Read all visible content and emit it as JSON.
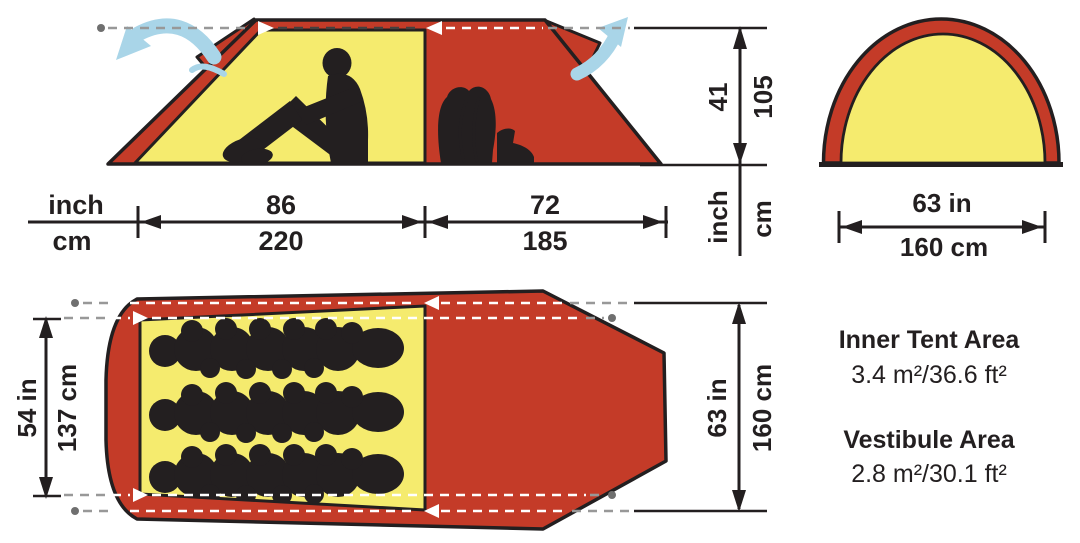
{
  "colors": {
    "red": "#c43b28",
    "yellow": "#f5eb6e",
    "ink": "#231f20",
    "blue": "#a9d5e8",
    "dash_gray": "#989898",
    "dash_dark": "#45403f",
    "dot_gray": "#6f6f6f"
  },
  "side_view": {
    "units": {
      "inch": "inch",
      "cm": "cm"
    },
    "inner_width": {
      "inch": "86",
      "cm": "220"
    },
    "vestibule_width": {
      "inch": "72",
      "cm": "185"
    },
    "height": {
      "inch": "41",
      "cm": "105"
    },
    "height_units": {
      "inch": "inch",
      "cm": "cm"
    }
  },
  "front_view": {
    "width": {
      "inch": "63 in",
      "cm": "160 cm"
    }
  },
  "floor_plan": {
    "inner_width": {
      "inch": "54 in",
      "cm": "137 cm"
    },
    "outer_width": {
      "inch": "63 in",
      "cm": "160 cm"
    }
  },
  "areas": {
    "inner": {
      "title": "Inner Tent Area",
      "value": "3.4 m²/36.6 ft²"
    },
    "vestibule": {
      "title": "Vestibule Area",
      "value": "2.8 m²/30.1 ft²"
    }
  }
}
